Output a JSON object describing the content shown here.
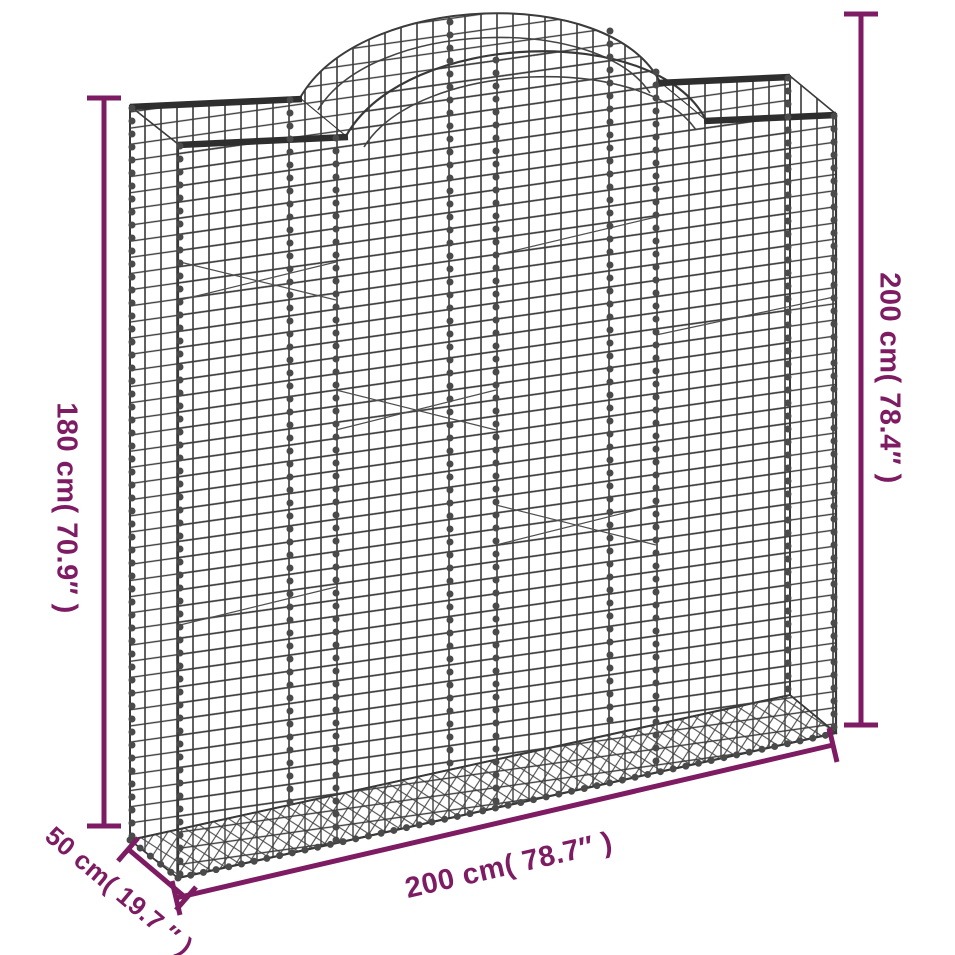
{
  "diagram": {
    "title": "Arched gabion basket dimension diagram",
    "colors": {
      "dimension_lines": "#7d1b63",
      "wire_mesh": "#3d3d3d",
      "background": "#ffffff"
    },
    "labels": {
      "height_left": "180 cm( 70.9″ )",
      "height_max_right": "200 cm( 78.4″ )",
      "width_bottom": "200 cm( 78.7″ )",
      "depth": "50 cm( 19.7 ″ )"
    }
  }
}
